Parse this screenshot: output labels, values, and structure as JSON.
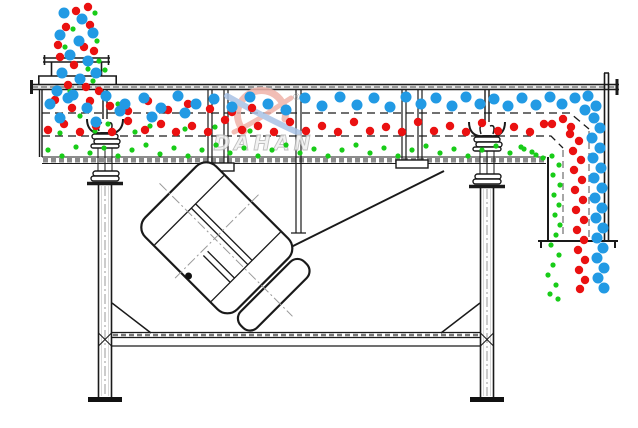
{
  "watermark": {
    "brand": "DAHAN",
    "registered": "®"
  },
  "colors": {
    "line": "#1a1a1a",
    "gray_dash": "#8a8a8a",
    "particle_large_blue": "#229AE4",
    "particle_medium_red": "#EA1111",
    "particle_small_green": "#18CC18",
    "watermark_red": "#EFB3AA",
    "watermark_blue": "#A9C3E6",
    "watermark_text_fill": "#F0F0F0",
    "watermark_text_stroke": "#B5B5B5"
  },
  "particles": {
    "blue": {
      "radius": 5.5,
      "color": "#229AE4",
      "points": [
        [
          64,
          13
        ],
        [
          82,
          19
        ],
        [
          60,
          35
        ],
        [
          79,
          41
        ],
        [
          93,
          33
        ],
        [
          70,
          55
        ],
        [
          88,
          61
        ],
        [
          62,
          73
        ],
        [
          80,
          79
        ],
        [
          96,
          73
        ],
        [
          57,
          91
        ],
        [
          73,
          95
        ],
        [
          50,
          104
        ],
        [
          68,
          98
        ],
        [
          87,
          108
        ],
        [
          106,
          96
        ],
        [
          125,
          104
        ],
        [
          144,
          98
        ],
        [
          161,
          108
        ],
        [
          178,
          96
        ],
        [
          196,
          104
        ],
        [
          214,
          99
        ],
        [
          232,
          107
        ],
        [
          250,
          97
        ],
        [
          268,
          104
        ],
        [
          286,
          110
        ],
        [
          305,
          98
        ],
        [
          322,
          106
        ],
        [
          340,
          97
        ],
        [
          357,
          105
        ],
        [
          374,
          98
        ],
        [
          390,
          107
        ],
        [
          406,
          97
        ],
        [
          421,
          104
        ],
        [
          436,
          98
        ],
        [
          452,
          106
        ],
        [
          466,
          97
        ],
        [
          480,
          104
        ],
        [
          494,
          99
        ],
        [
          508,
          106
        ],
        [
          522,
          98
        ],
        [
          536,
          105
        ],
        [
          550,
          97
        ],
        [
          562,
          104
        ],
        [
          575,
          98
        ],
        [
          96,
          122
        ],
        [
          120,
          111
        ],
        [
          152,
          117
        ],
        [
          185,
          113
        ],
        [
          60,
          118
        ],
        [
          588,
          96
        ],
        [
          596,
          106
        ],
        [
          585,
          110
        ],
        [
          594,
          118
        ],
        [
          600,
          128
        ],
        [
          592,
          138
        ],
        [
          600,
          148
        ],
        [
          593,
          158
        ],
        [
          601,
          168
        ],
        [
          594,
          178
        ],
        [
          602,
          188
        ],
        [
          595,
          198
        ],
        [
          602,
          208
        ],
        [
          596,
          218
        ],
        [
          603,
          228
        ],
        [
          597,
          238
        ],
        [
          603,
          248
        ],
        [
          597,
          258
        ],
        [
          604,
          268
        ],
        [
          598,
          278
        ],
        [
          604,
          288
        ]
      ]
    },
    "red": {
      "radius": 4.2,
      "color": "#EA1111",
      "points": [
        [
          76,
          11
        ],
        [
          90,
          25
        ],
        [
          66,
          27
        ],
        [
          84,
          47
        ],
        [
          60,
          57
        ],
        [
          74,
          65
        ],
        [
          94,
          51
        ],
        [
          68,
          85
        ],
        [
          86,
          87
        ],
        [
          99,
          91
        ],
        [
          58,
          45
        ],
        [
          88,
          7
        ],
        [
          55,
          100
        ],
        [
          72,
          108
        ],
        [
          90,
          101
        ],
        [
          110,
          106
        ],
        [
          128,
          111
        ],
        [
          148,
          101
        ],
        [
          168,
          110
        ],
        [
          188,
          104
        ],
        [
          210,
          109
        ],
        [
          232,
          112
        ],
        [
          252,
          108
        ],
        [
          48,
          130
        ],
        [
          64,
          124
        ],
        [
          80,
          132
        ],
        [
          96,
          126
        ],
        [
          112,
          132
        ],
        [
          128,
          121
        ],
        [
          145,
          130
        ],
        [
          161,
          124
        ],
        [
          176,
          132
        ],
        [
          192,
          126
        ],
        [
          208,
          132
        ],
        [
          225,
          120
        ],
        [
          242,
          130
        ],
        [
          258,
          126
        ],
        [
          274,
          132
        ],
        [
          290,
          122
        ],
        [
          306,
          131
        ],
        [
          322,
          126
        ],
        [
          338,
          132
        ],
        [
          354,
          122
        ],
        [
          370,
          131
        ],
        [
          386,
          127
        ],
        [
          402,
          132
        ],
        [
          418,
          122
        ],
        [
          434,
          131
        ],
        [
          450,
          126
        ],
        [
          466,
          132
        ],
        [
          482,
          123
        ],
        [
          498,
          131
        ],
        [
          514,
          127
        ],
        [
          530,
          132
        ],
        [
          544,
          124
        ],
        [
          552,
          124
        ],
        [
          563,
          119
        ],
        [
          571,
          127
        ],
        [
          570,
          134
        ],
        [
          579,
          141
        ],
        [
          573,
          151
        ],
        [
          581,
          160
        ],
        [
          574,
          170
        ],
        [
          582,
          180
        ],
        [
          575,
          190
        ],
        [
          583,
          200
        ],
        [
          576,
          210
        ],
        [
          584,
          220
        ],
        [
          577,
          230
        ],
        [
          584,
          240
        ],
        [
          578,
          250
        ],
        [
          585,
          260
        ],
        [
          579,
          270
        ],
        [
          585,
          280
        ],
        [
          580,
          289
        ]
      ]
    },
    "green": {
      "radius": 2.6,
      "color": "#18CC18",
      "points": [
        [
          95,
          13
        ],
        [
          73,
          29
        ],
        [
          97,
          41
        ],
        [
          65,
          47
        ],
        [
          88,
          69
        ],
        [
          99,
          61
        ],
        [
          70,
          91
        ],
        [
          93,
          81
        ],
        [
          105,
          70
        ],
        [
          118,
          104
        ],
        [
          150,
          126
        ],
        [
          185,
          129
        ],
        [
          215,
          127
        ],
        [
          250,
          131
        ],
        [
          80,
          116
        ],
        [
          108,
          124
        ],
        [
          135,
          132
        ],
        [
          60,
          133
        ],
        [
          95,
          131
        ],
        [
          48,
          150
        ],
        [
          62,
          156
        ],
        [
          76,
          147
        ],
        [
          90,
          153
        ],
        [
          104,
          148
        ],
        [
          118,
          156
        ],
        [
          132,
          150
        ],
        [
          146,
          145
        ],
        [
          160,
          154
        ],
        [
          174,
          148
        ],
        [
          188,
          156
        ],
        [
          202,
          150
        ],
        [
          216,
          145
        ],
        [
          230,
          153
        ],
        [
          244,
          148
        ],
        [
          258,
          156
        ],
        [
          272,
          150
        ],
        [
          286,
          145
        ],
        [
          300,
          153
        ],
        [
          314,
          149
        ],
        [
          328,
          156
        ],
        [
          342,
          150
        ],
        [
          356,
          145
        ],
        [
          370,
          153
        ],
        [
          384,
          148
        ],
        [
          398,
          156
        ],
        [
          412,
          150
        ],
        [
          426,
          146
        ],
        [
          440,
          153
        ],
        [
          454,
          149
        ],
        [
          468,
          156
        ],
        [
          482,
          150
        ],
        [
          496,
          146
        ],
        [
          510,
          153
        ],
        [
          524,
          149
        ],
        [
          536,
          155
        ],
        [
          521,
          147
        ],
        [
          532,
          152
        ],
        [
          543,
          158
        ],
        [
          552,
          156
        ],
        [
          559,
          165
        ],
        [
          553,
          175
        ],
        [
          560,
          185
        ],
        [
          554,
          195
        ],
        [
          559,
          205
        ],
        [
          555,
          215
        ],
        [
          560,
          225
        ],
        [
          556,
          235
        ],
        [
          551,
          245
        ],
        [
          559,
          255
        ],
        [
          553,
          265
        ],
        [
          548,
          275
        ],
        [
          556,
          285
        ],
        [
          550,
          294
        ],
        [
          558,
          299
        ]
      ]
    }
  }
}
